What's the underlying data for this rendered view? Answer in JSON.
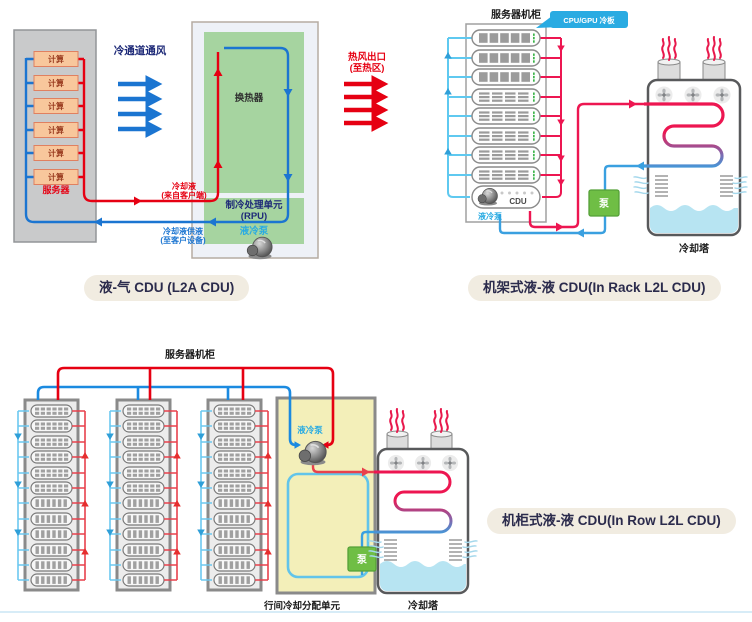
{
  "labels": {
    "l2a": {
      "pill": "液-气 CDU (L2A CDU)",
      "compute": "计算",
      "server": "服务器",
      "cold_aisle": "冷通道通风",
      "hot_out1": "热风出口",
      "hot_out2": "(至热区)",
      "coolant_in1": "冷却液",
      "coolant_in2": "(来自客户端)",
      "coolant_supply1": "冷却液供液",
      "coolant_supply2": "(至客户设备)",
      "heat_exchanger": "换热器",
      "rpu1": "制冷处理单元",
      "rpu2": "(RPU)",
      "pump": "液冷泵"
    },
    "in_rack": {
      "pill": "机架式液-液 CDU(In Rack L2L CDU)",
      "cabinet": "服务器机柜",
      "coldplate_tag": "CPU/GPU 冷板",
      "cdu": "CDU",
      "pump": "液冷泵",
      "pump_box": "泵",
      "tower": "冷却塔"
    },
    "in_row": {
      "pill": "机柜式液-液 CDU(In Row L2L CDU)",
      "cabinet": "服务器机柜",
      "unit": "行间冷却分配单元",
      "pump": "液冷泵",
      "pump_box": "泵",
      "tower": "冷却塔"
    }
  },
  "colors": {
    "hot_red": "#e60012",
    "hot_crimson": "#ed1651",
    "cold_blue": "#1b75d1",
    "cold_light": "#5fc9f0",
    "return_blue": "#3aa0e0",
    "pump_green": "#6fbe45",
    "hx_green": "#a6d4a0",
    "unit_yellow": "#f3efb9",
    "tag_blue": "#29abe2",
    "pill_bg": "#f1ece1",
    "navy_text": "#1e2a78",
    "water_blue": "#b7e4f2"
  }
}
